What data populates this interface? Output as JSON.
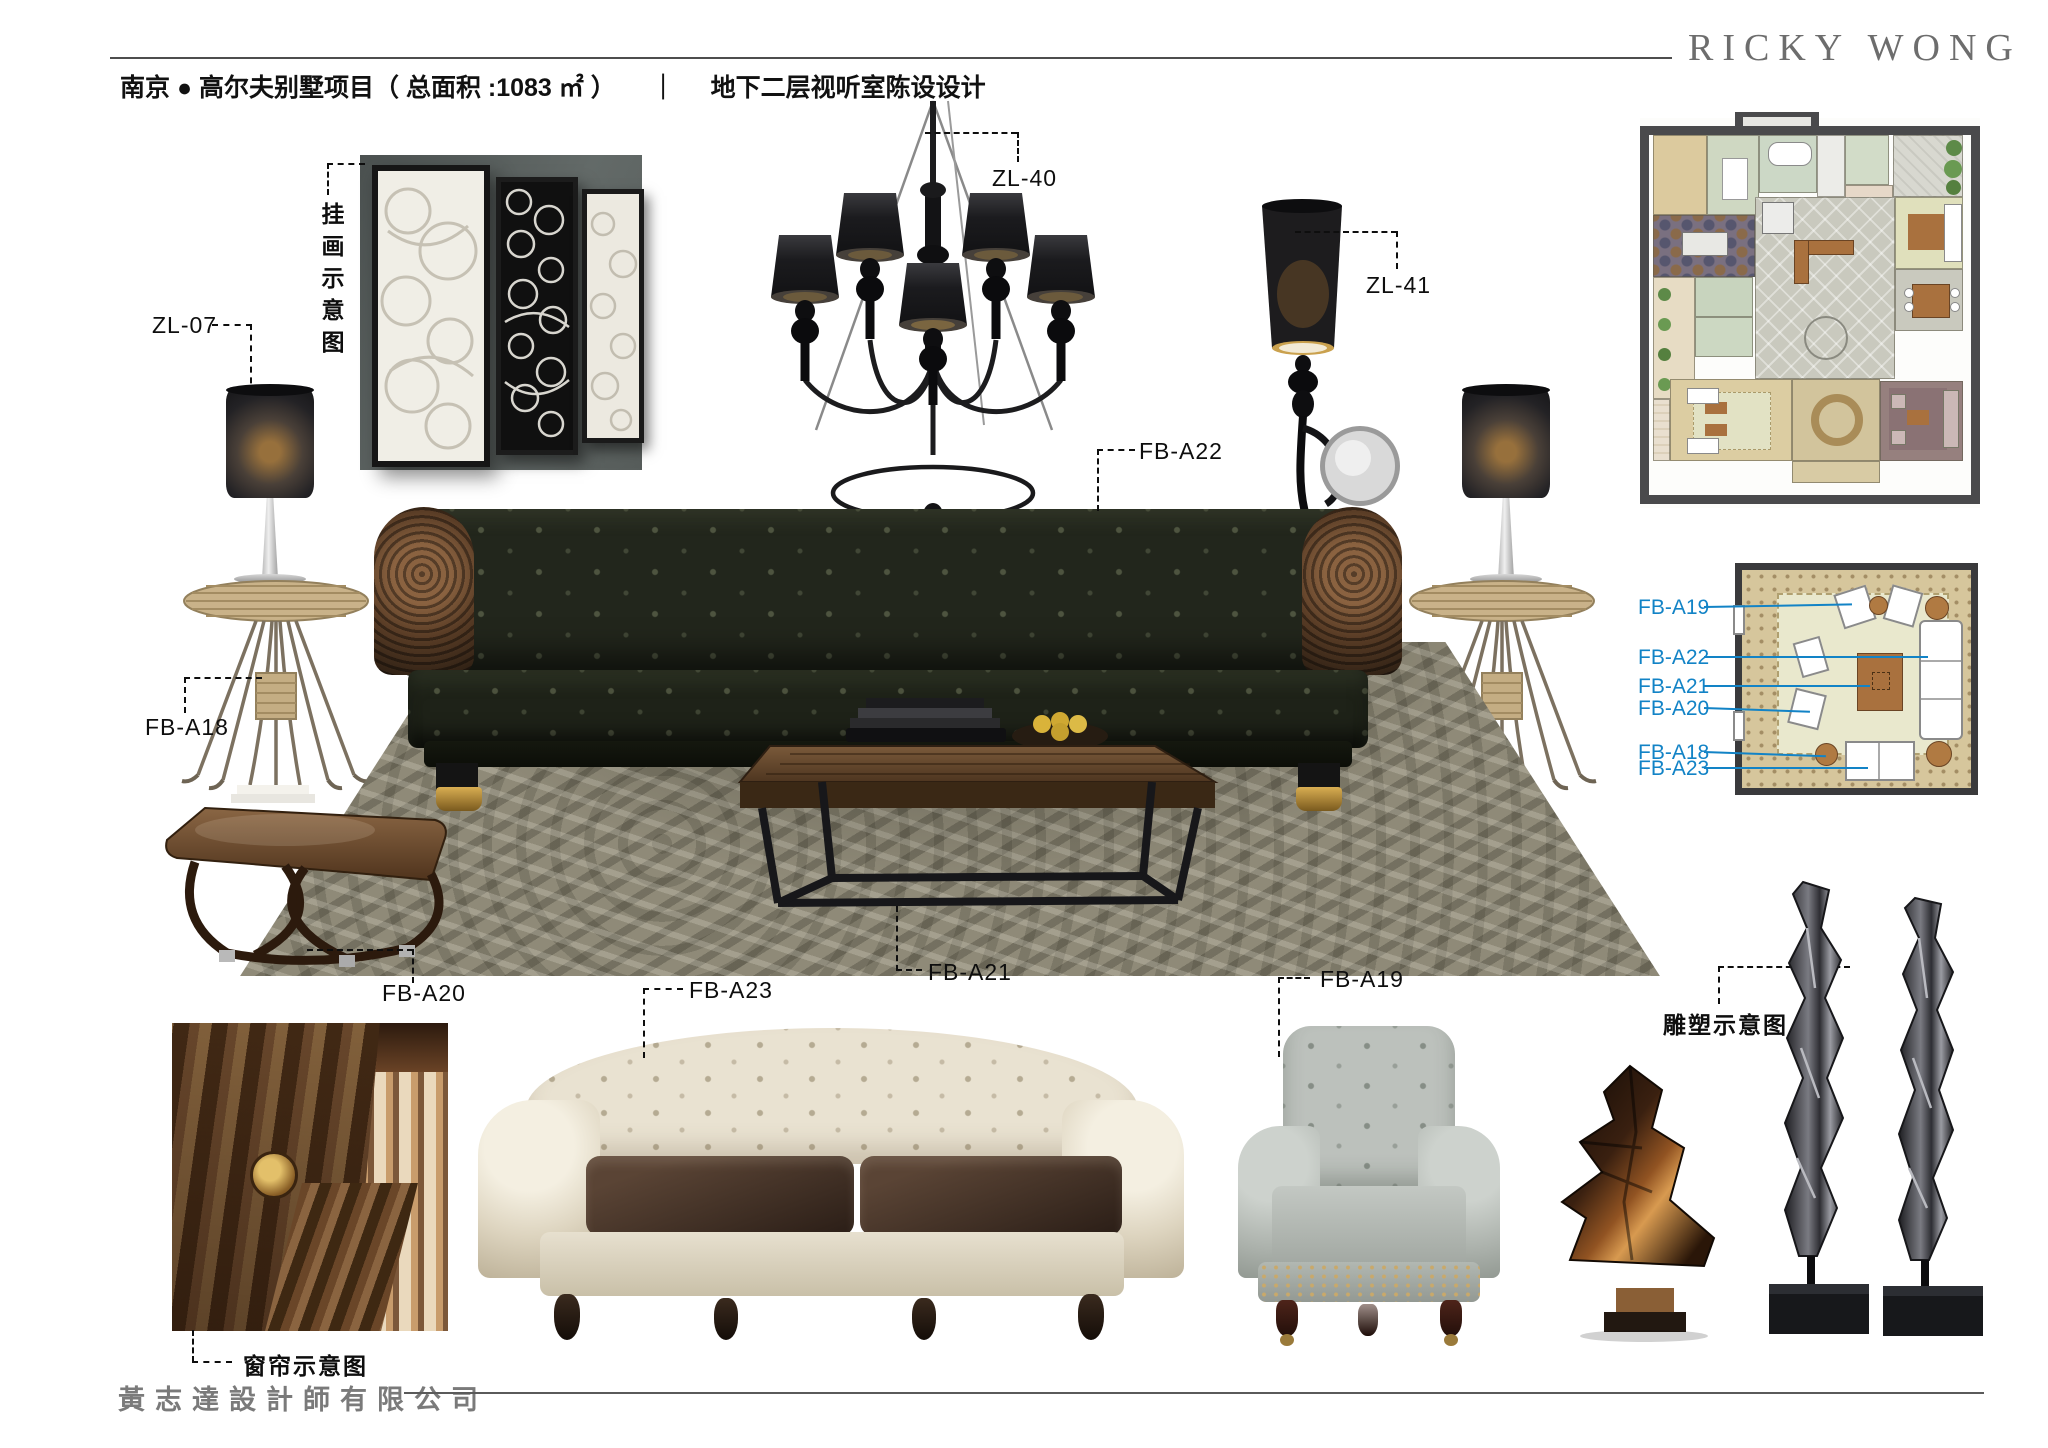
{
  "header": {
    "brand": "RICKY WONG",
    "project": "南京 ● 高尔夫别墅项目（ 总面积 :1083 ㎡ ）",
    "divider": "｜",
    "subtitle": "地下二层视听室陈设设计"
  },
  "footer": {
    "company": "黃志達設計師有限公司"
  },
  "labels": {
    "artwork_note": "挂画示意图",
    "zl07": "ZL-07",
    "zl40": "ZL-40",
    "zl41": "ZL-41",
    "fb_a22": "FB-A22",
    "fb_a18": "FB-A18",
    "fb_a20": "FB-A20",
    "fb_a21": "FB-A21",
    "fb_a23": "FB-A23",
    "fb_a19": "FB-A19",
    "sculpture_note": "雕塑示意图",
    "curtain_note": "窗帘示意图"
  },
  "plan2": {
    "labels": [
      "FB-A19",
      "FB-A22",
      "FB-A21",
      "FB-A20",
      "FB-A18",
      "FB-A23"
    ]
  },
  "colors": {
    "accent_blue": "#1283c6",
    "page_bg": "#ffffff",
    "rule_gray": "#4d4d4d"
  }
}
